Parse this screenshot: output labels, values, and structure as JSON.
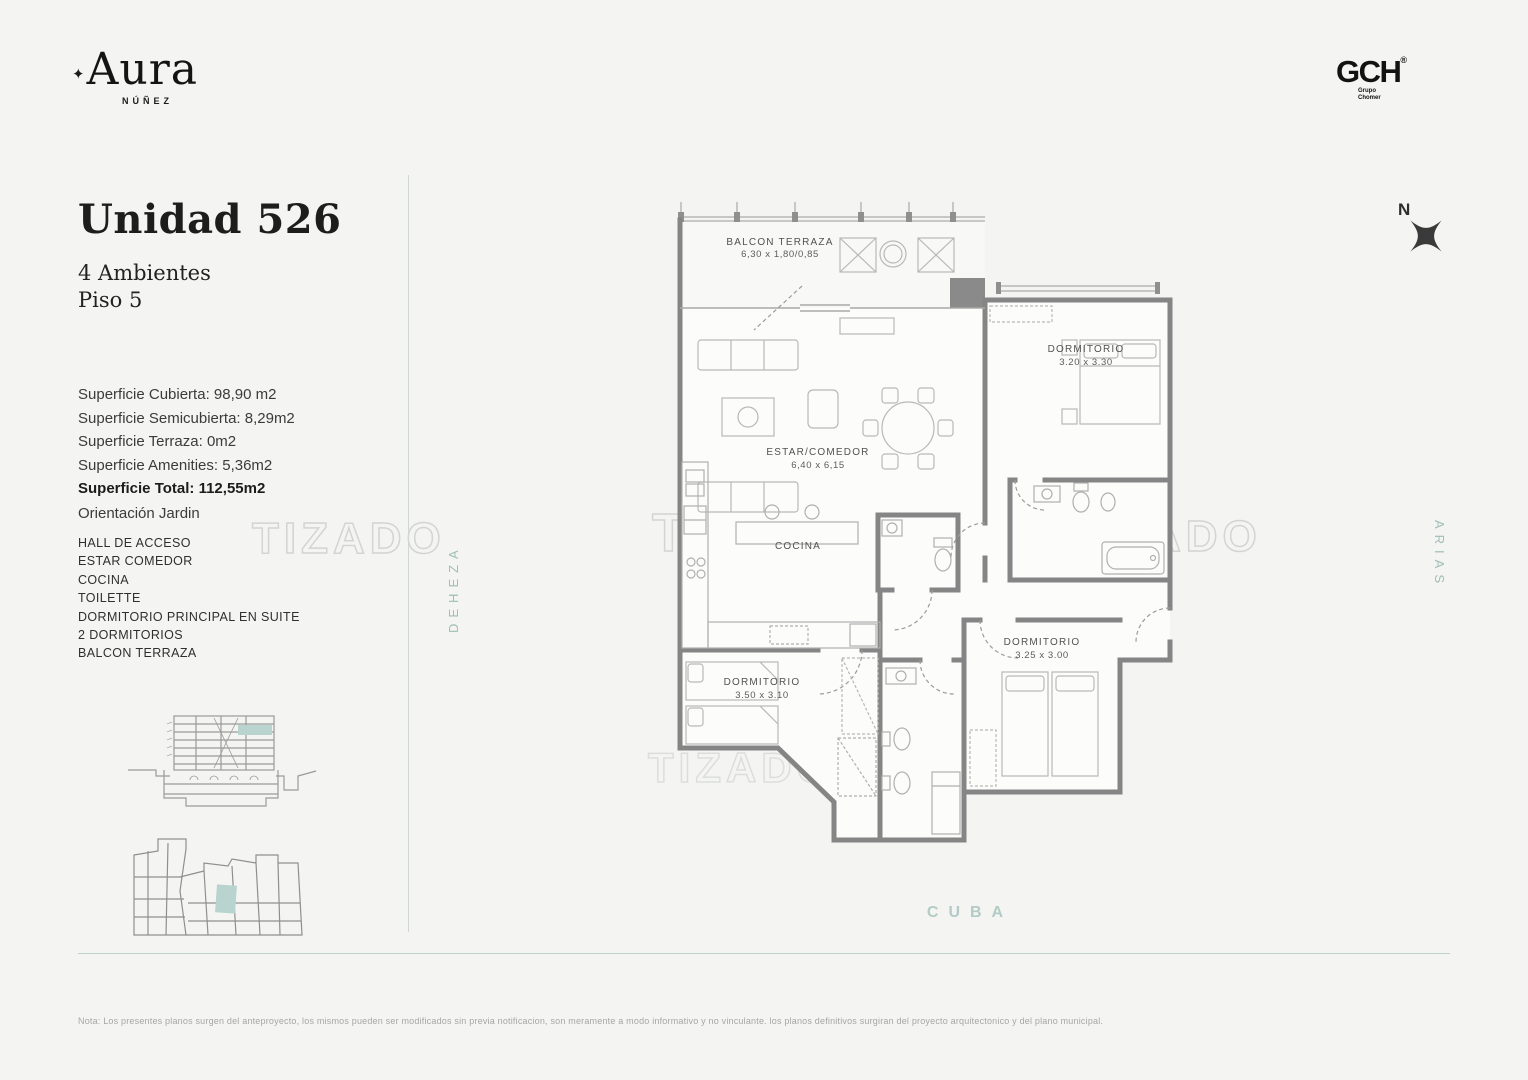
{
  "brand": {
    "mark": "✦",
    "name": "Aura",
    "location": "NÚÑEZ"
  },
  "developer": {
    "name": "GCH",
    "registered": "®",
    "subtitle_1": "Grupo",
    "subtitle_2": "Chomer"
  },
  "unit": {
    "title": "Unidad 526",
    "ambientes": "4 Ambientes",
    "piso": "Piso 5",
    "surfaces": [
      "Superficie Cubierta: 98,90 m2",
      "Superficie Semicubierta: 8,29m2",
      "Superficie Terraza: 0m2",
      "Superficie Amenities: 5,36m2"
    ],
    "surface_total": "Superficie Total: 112,55m2",
    "orientation": "Orientación Jardin",
    "rooms": [
      "HALL DE ACCESO",
      "ESTAR COMEDOR",
      "COCINA",
      "TOILETTE",
      "DORMITORIO PRINCIPAL EN SUITE",
      "2 DORMITORIOS",
      "BALCON TERRAZA"
    ]
  },
  "plan": {
    "balcony": {
      "label": "BALCON TERRAZA",
      "dims": "6,30 x 1,80/0,85"
    },
    "living": {
      "label": "ESTAR/COMEDOR",
      "dims": "6,40 x 6,15"
    },
    "kitchen": {
      "label": "COCINA"
    },
    "bedroom_suite": {
      "label": "DORMITORIO",
      "dims": "3.20 x 3.30"
    },
    "bedroom_left": {
      "label": "DORMITORIO",
      "dims": "3.50 x 3.10"
    },
    "bedroom_right": {
      "label": "DORMITORIO",
      "dims": "3.25 x 3.00"
    }
  },
  "streets": {
    "west": "DEHEZA",
    "east": "ARIAS",
    "south": "CUBA"
  },
  "compass": {
    "label": "N"
  },
  "watermark": "TIZADO",
  "footer_note": "Nota: Los presentes planos surgen del anteproyecto, los mismos pueden ser modificados sin previa notificacion, son meramente a modo informativo y no vinculante. los planos definitivos surgiran del proyecto arquitectonico y del plano municipal.",
  "colors": {
    "background": "#f4f4f2",
    "accent_teal": "#9fbeb8",
    "highlight_unit": "#b9d4cf",
    "wall": "#858585"
  }
}
